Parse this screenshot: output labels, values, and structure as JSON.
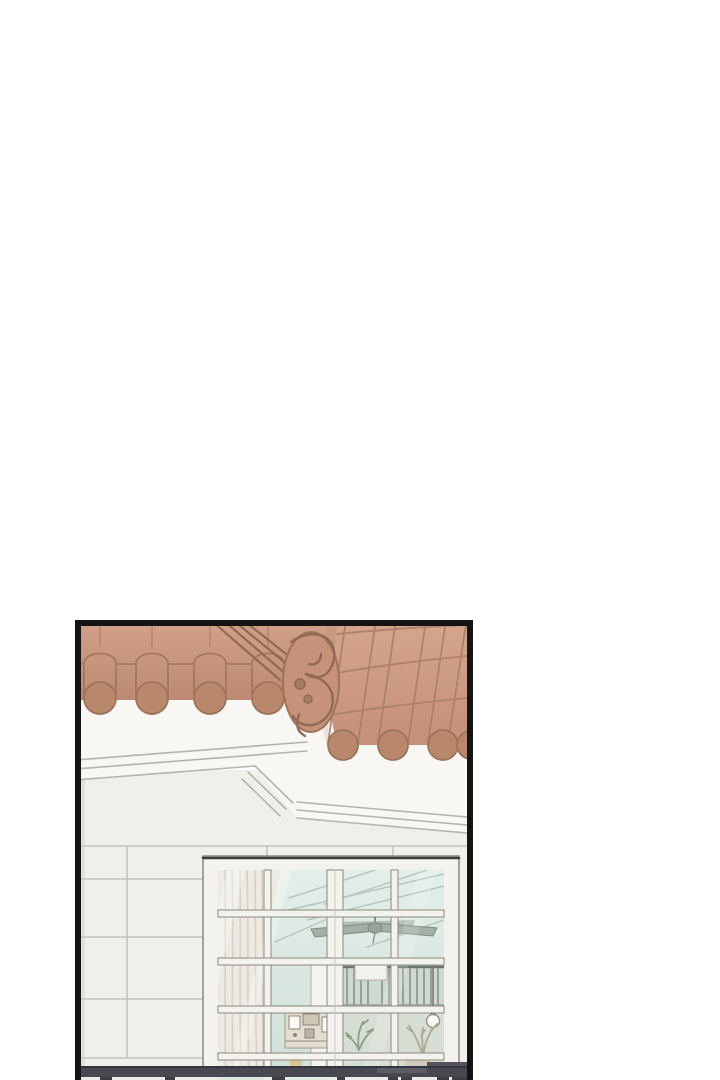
{
  "page": {
    "background": "#ffffff",
    "kind": "webtoon vertical-scroll page segment, blank gutter above a single comic panel"
  },
  "panel": {
    "alt": "Comic panel: exterior of a white stucco house with a terracotta barrel-tile roof and a decorative swirled gable ornament; below, a large white-gridded window reveals an interior with sheer curtains, a ceiling fan, a loft railing, a hanging light bulb, shelves with picture frames and plants; a dark balcony handrail crosses the bottom of the panel.",
    "colors": {
      "page_bg": "#ffffff",
      "panel_bg": "#fdfdfd",
      "panel_border": "#141414",
      "tile_light": "#d3a189",
      "tile_base": "#c6927a",
      "tile_shade": "#bc8a70",
      "tile_end": "#b9876c",
      "tile_outline": "#9c7459",
      "ridge_line": "#8f6b55",
      "fascia": "#f8f7f4",
      "fascia_line": "#b5b3ac",
      "wall": "#f1efeb",
      "wall_seam": "#c6c3bc",
      "frame": "#f3f2ee",
      "frame_outline": "#8a887f",
      "frame_dark_edge": "#3c3c38",
      "glass_top": "#e4eee9",
      "glass_bottom": "#cfe0d8",
      "glass_line": "#b2c2ba",
      "interior_warm": "#d9dccf",
      "curtain": "#edeae2",
      "curtain_fold": "#d5d1c5",
      "fan_blade": "#a3b1a4",
      "fan_outline": "#7e8c80",
      "slat": "#8d998e",
      "slat_rail": "#6b756c",
      "pillar": "#f4f3ef",
      "bulb": "#fbfaf6",
      "cord": "#7a756b",
      "shelf_bg": "#e3ded2",
      "shelf_outline": "#a09a8a",
      "vent": "#f6f5f1",
      "plant": "#8aa184",
      "dry_plant": "#b0a894",
      "item_yellow": "#d9c88f",
      "railing": "#474850",
      "railing_dark": "#343540",
      "railing_light": "#5d5f66",
      "railing_step": "#52545a",
      "post": "#3e3f45",
      "below_rail_bg": "#ebebe8"
    }
  }
}
